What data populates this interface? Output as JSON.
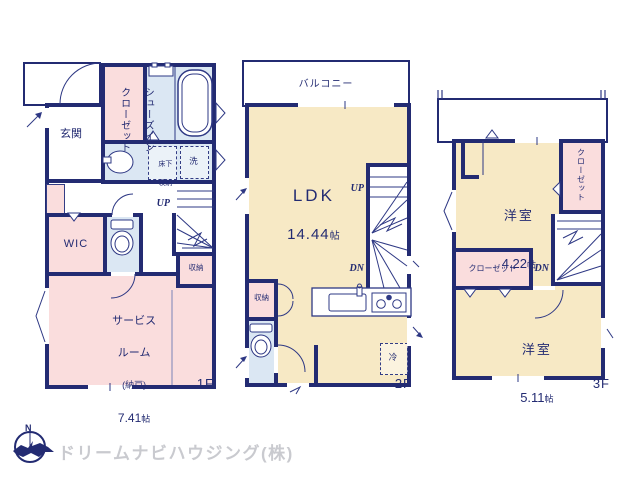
{
  "colors": {
    "wall_navy": "#232b72",
    "room_pink": "#fadddd",
    "room_cream": "#f7e9c5",
    "room_blue": "#dbe7f3",
    "fixture_line": "#2e3884",
    "logo_gray": "#c9cacf"
  },
  "floor1": {
    "label": "1F",
    "entrance": "玄関",
    "shoe_closet_line1": "シューズイン",
    "shoe_closet_line2": "クローゼット",
    "underfloor_line1": "床下",
    "underfloor_line2": "収納",
    "washer": "洗",
    "wic": "WIC",
    "up": "UP",
    "storage": "収納",
    "service_name_line1": "サービス",
    "service_name_line2": "ルーム",
    "service_sub": "(納戸)",
    "service_size_num": "7.41",
    "service_size_unit": "帖"
  },
  "floor2": {
    "label": "2F",
    "balcony": "バルコニー",
    "ldk_name": "LDK",
    "ldk_size_num": "14.44",
    "ldk_size_unit": "帖",
    "up": "UP",
    "dn": "DN",
    "storage": "収納",
    "fridge": "冷"
  },
  "floor3": {
    "label": "3F",
    "room1_name": "洋室",
    "room1_size_num": "4.22",
    "room1_size_unit": "帖",
    "closet_top": "クローゼット",
    "closet_bottom": "クローゼット",
    "dn": "DN",
    "room2_name": "洋室",
    "room2_size_num": "5.11",
    "room2_size_unit": "帖"
  },
  "footer": {
    "company": "ドリームナビハウジング(株)",
    "compass_n": "N"
  }
}
